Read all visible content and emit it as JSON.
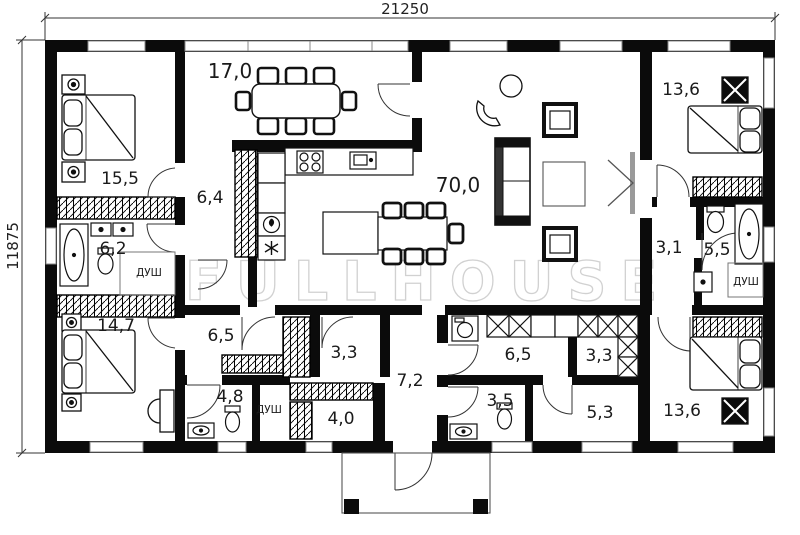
{
  "dimensions": {
    "width_label": "21250",
    "height_label": "11875"
  },
  "watermark": "FULLHOUSE",
  "labels": {
    "dining": "17,0",
    "bedroom_tl": "15,5",
    "hall": "6,4",
    "bath_main": "6,2",
    "shower_main": "ДУШ",
    "living": "70,0",
    "bedroom_tr": "13,6",
    "hall_small": "3,1",
    "bath_right": "5,5",
    "shower_right": "ДУШ",
    "bedroom_bl": "14,7",
    "room_65l": "6,5",
    "closet_33l": "3,3",
    "wc_48": "4,8",
    "shower_left": "ДУШ",
    "entry_40": "4,0",
    "corridor_72": "7,2",
    "wc_35": "3,5",
    "laundry_65r": "6,5",
    "pantry_33r": "3,3",
    "hall_53": "5,3",
    "bedroom_br": "13,6"
  }
}
